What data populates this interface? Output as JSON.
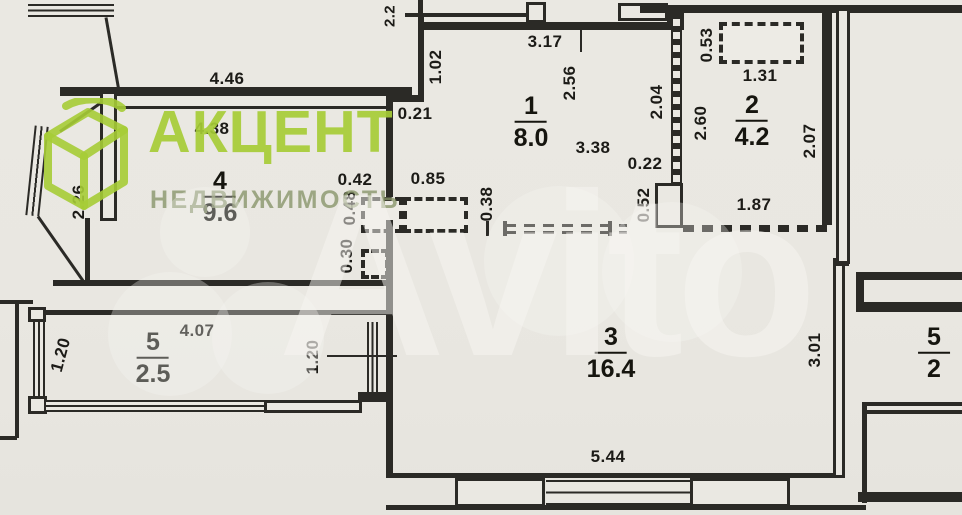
{
  "brand": {
    "title": "АКЦЕНТ",
    "subtitle": "НЕДВИЖИМОСТЬ",
    "accent_color": "#a6cc36",
    "subtitle_color": "#879468"
  },
  "watermark": {
    "text": "Avito",
    "color": "#f7f6f2"
  },
  "colors": {
    "paper": "#e9e7e1",
    "ink": "#2b2a26"
  },
  "rooms": {
    "r1": {
      "number": "1",
      "area": "8.0"
    },
    "r2": {
      "number": "2",
      "area": "4.2"
    },
    "r3": {
      "number": "3",
      "area": "16.4"
    },
    "r4": {
      "number": "4",
      "area": "9.6"
    },
    "r5": {
      "number": "5",
      "area": "2.5"
    },
    "adj": {
      "number": "5",
      "area": "2"
    }
  },
  "dims": {
    "top_446": "4.46",
    "room4_438": "4.38",
    "room4_226": "2.26",
    "top_22": "2.2",
    "hall_102": "1.02",
    "hall_021": "0.21",
    "hall_317": "3.17",
    "hall_256": "2.56",
    "hall_338": "3.38",
    "hall_204": "2.04",
    "bath_053": "0.53",
    "bath_131": "1.31",
    "bath_260": "2.60",
    "bath_207": "2.07",
    "bath_187": "1.87",
    "bath_022": "0.22",
    "bath_052": "0.52",
    "mid_042": "0.42",
    "mid_085": "0.85",
    "mid_048": "0.48",
    "mid_030": "0.30",
    "mid_038": "0.38",
    "balc_120_left": "1.20",
    "balc_407": "4.07",
    "balc_120_right": "1.20",
    "room3_301": "3.01",
    "room3_544": "5.44"
  }
}
